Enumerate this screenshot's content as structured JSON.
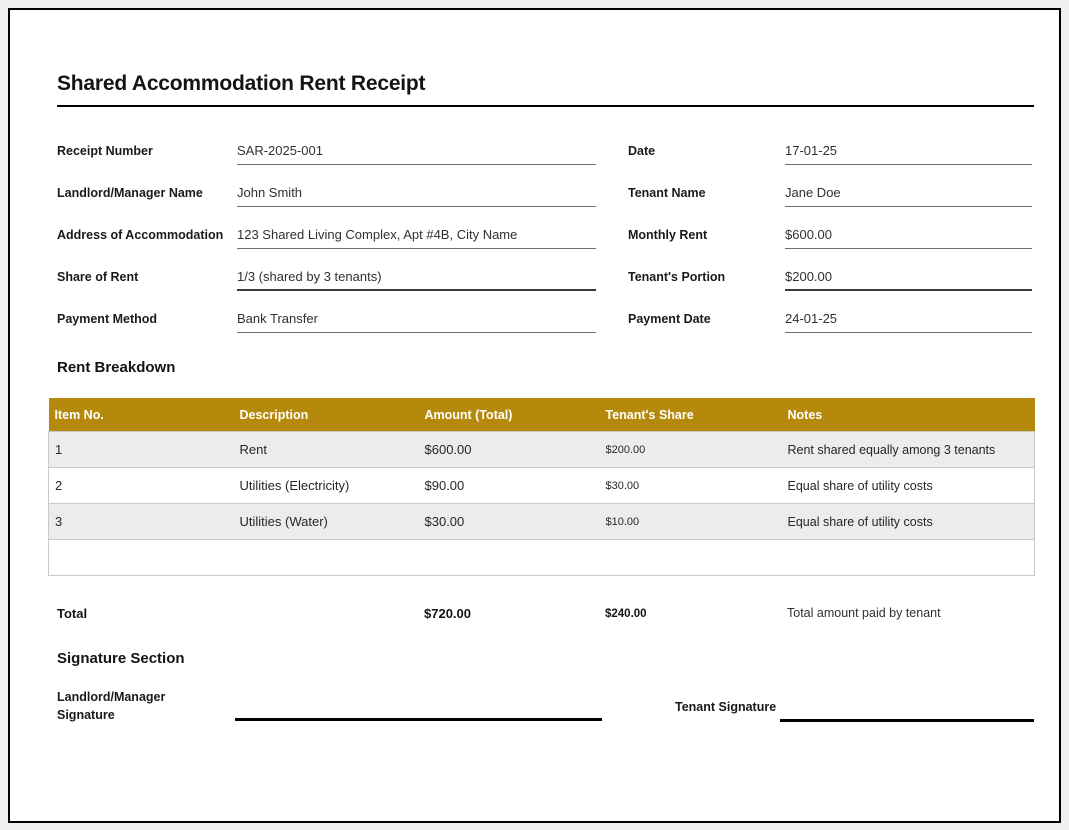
{
  "title": "Shared Accommodation Rent Receipt",
  "fields": {
    "left": [
      {
        "label": "Receipt Number",
        "value": "SAR-2025-001"
      },
      {
        "label": "Landlord/Manager Name",
        "value": "John Smith"
      },
      {
        "label": "Address of Accommodation",
        "value": "123 Shared Living Complex, Apt #4B, City Name"
      },
      {
        "label": "Share of Rent",
        "value": "1/3 (shared by 3 tenants)"
      },
      {
        "label": "Payment Method",
        "value": "Bank Transfer"
      }
    ],
    "right": [
      {
        "label": "Date",
        "value": "17-01-25"
      },
      {
        "label": "Tenant Name",
        "value": "Jane Doe"
      },
      {
        "label": "Monthly Rent",
        "value": "$600.00"
      },
      {
        "label": "Tenant's Portion",
        "value": "$200.00"
      },
      {
        "label": "Payment Date",
        "value": "24-01-25"
      }
    ]
  },
  "breakdown": {
    "heading": "Rent Breakdown",
    "columns": [
      "Item No.",
      "Description",
      "Amount (Total)",
      "Tenant's Share",
      "Notes"
    ],
    "rows": [
      [
        "1",
        "Rent",
        "$600.00",
        "$200.00",
        "Rent shared equally among 3 tenants"
      ],
      [
        "2",
        "Utilities (Electricity)",
        "$90.00",
        "$30.00",
        "Equal share of utility costs"
      ],
      [
        "3",
        "Utilities (Water)",
        "$30.00",
        "$10.00",
        "Equal share of utility costs"
      ]
    ],
    "total": {
      "label": "Total",
      "amount": "$720.00",
      "tenant_share": "$240.00",
      "note": "Total amount paid by tenant"
    }
  },
  "signature": {
    "heading": "Signature Section",
    "landlord_label": "Landlord/Manager Signature",
    "tenant_label": "Tenant Signature"
  },
  "colors": {
    "page_border": "#000000",
    "table_header_bg": "#B5890C",
    "table_header_text": "#FFFFFF",
    "banded_row_bg": "#ECECEC",
    "table_border": "#C9C9C9",
    "field_line": "#6E6E6E"
  }
}
